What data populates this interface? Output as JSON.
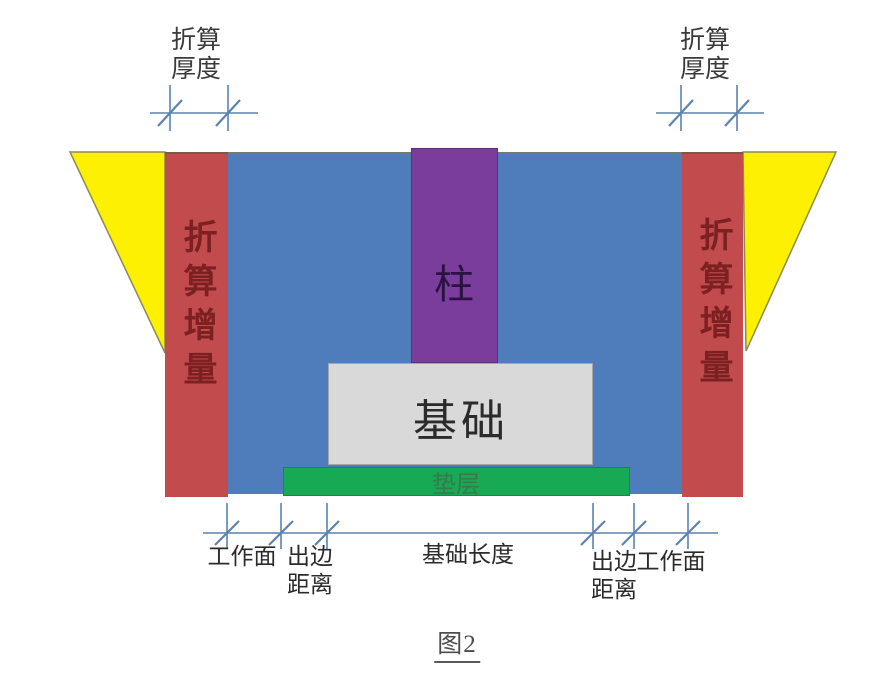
{
  "figure": {
    "caption": "图2",
    "regions": {
      "column_label": "柱",
      "foundation_label": "基础",
      "cushion_label": "垫层",
      "increment_left_label": "折算增量",
      "increment_right_label": "折算增量"
    },
    "dimension_labels": {
      "thickness_top_left": "折算\n厚度",
      "thickness_top_right": "折算\n厚度",
      "work_face_left": "工作面",
      "edge_distance_left": "出边\n距离",
      "foundation_length": "基础长度",
      "edge_distance_right": "出边\n距离",
      "work_face_right": "工作面"
    },
    "colors": {
      "soil_blue": "#4f7cba",
      "increment_red": "#c14b4d",
      "slope_yellow": "#fdf000",
      "column_purple": "#7a3d9c",
      "foundation_gray": "#d9d9d9",
      "cushion_green": "#17a953",
      "dimension_line": "#5b82b0",
      "increment_text_red": "#7c2022"
    }
  }
}
